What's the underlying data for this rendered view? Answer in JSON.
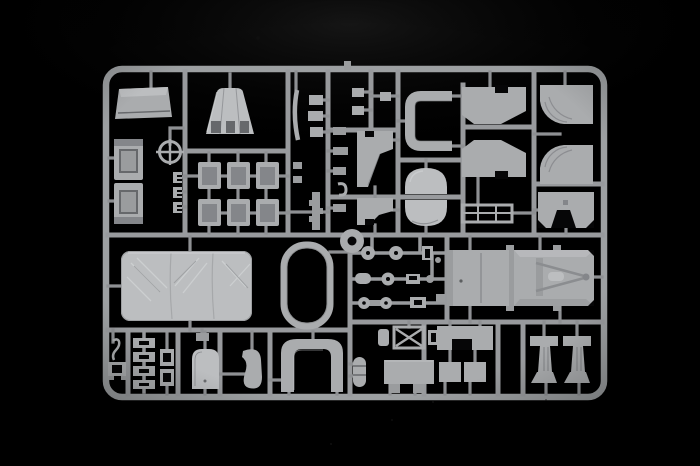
{
  "scene": {
    "type": "photograph",
    "subject": "plastic model kit sprue",
    "description": "Grey injection-molded model kit sprue (parts tree) with unpainted truck parts, photographed on a black background",
    "text_visible": false,
    "objects": [
      "sprue-frame-with-rounded-corners",
      "cargo-tray-part",
      "air-cleaner-cone-part",
      "door-panel-upper",
      "door-panel-lower",
      "crosshair-sight-ring",
      "retaining-clips",
      "seat-back-grid-of-six",
      "thin-curved-strip",
      "small-bracket-parts",
      "spine-lug-parts",
      "front-fender-upper",
      "front-fender-lower",
      "fuel-tank-half-upper",
      "fuel-tank-half-lower",
      "windshield-u-frame",
      "flat-rail-frame",
      "cab-corner-panel-top-left",
      "cab-corner-panel-bottom-left",
      "wheel-arch-panel-top-right",
      "wheel-arch-panel-bottom-right",
      "notched-bulkhead-panel",
      "canvas-tarp-part",
      "stadium-ring-part",
      "donut-ring-part",
      "truck-bed-floor-with-tow-hitch",
      "road-wheels",
      "axle-hubs",
      "transmission-parts",
      "x-brace-mount",
      "notched-plate",
      "storage-box-parts",
      "ribbed-oval-part",
      "mudflap-left",
      "mudflap-right",
      "hook-bracket",
      "ladder-stack-parts",
      "paired-block-parts",
      "rounded-door-part",
      "kidney-shaped-part",
      "arch-frame-part"
    ]
  },
  "colors": {
    "bg": "#000000",
    "haze": "#181818",
    "frame": "#9da0a2",
    "runner": "#989a9d",
    "stub": "#8e9093",
    "part": "#aaacae",
    "partLight": "#bcbec0",
    "partMid": "#9a9c9e",
    "partDark": "#84868a",
    "recess": "#66686b",
    "cut": "#060607",
    "highlight": "#d2d4d6"
  }
}
